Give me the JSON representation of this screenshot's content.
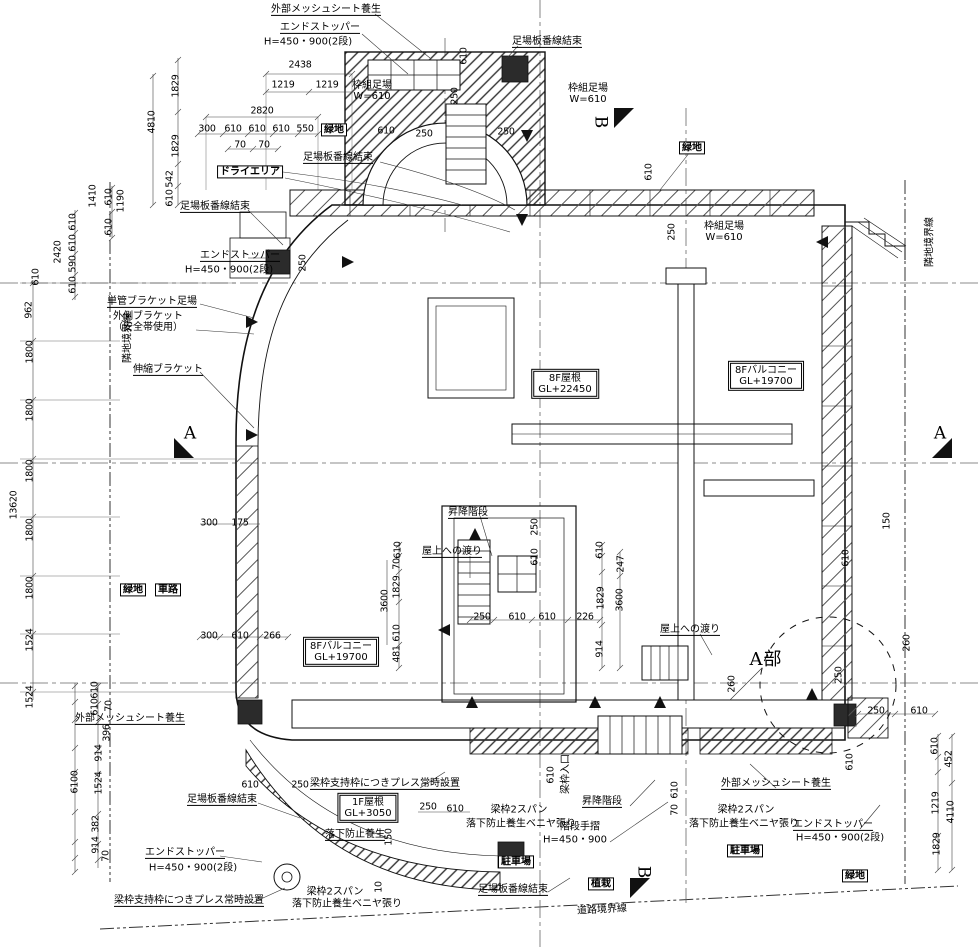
{
  "drawing": {
    "type": "scaffolding-plan",
    "canvas": {
      "width": 980,
      "height": 947
    },
    "colors": {
      "line": "#1a1a1a",
      "dim_line": "#444444",
      "background": "#ffffff"
    }
  },
  "labels": [
    {
      "name": "label-ext-mesh-sheet-top",
      "text": "外部メッシュシート養生",
      "x": 326,
      "y": 10,
      "cls": "u"
    },
    {
      "name": "label-end-stopper-top",
      "text": "エンドストッパー",
      "x": 320,
      "y": 28,
      "cls": "u"
    },
    {
      "name": "label-end-stopper-top-size",
      "text": "H=450・900(2段)",
      "x": 308,
      "y": 42
    },
    {
      "name": "label-scaffold-tie-top",
      "text": "足場板番線結束",
      "x": 547,
      "y": 42,
      "cls": "u"
    },
    {
      "name": "dim-label",
      "text": "2438",
      "x": 300,
      "y": 66,
      "cls": "dim"
    },
    {
      "name": "dim-label",
      "text": "1219",
      "x": 283,
      "y": 86,
      "cls": "dim"
    },
    {
      "name": "dim-label",
      "text": "1219",
      "x": 327,
      "y": 86,
      "cls": "dim"
    },
    {
      "name": "label-frame-scaffold-top-left",
      "text": "枠組足場\nW=610",
      "x": 372,
      "y": 91
    },
    {
      "name": "dim-label",
      "text": "610",
      "x": 465,
      "y": 56,
      "rot": -90,
      "cls": "dim"
    },
    {
      "name": "dim-label",
      "text": "250",
      "x": 456,
      "y": 96,
      "rot": -90,
      "cls": "dim"
    },
    {
      "name": "label-frame-scaffold-top-right",
      "text": "枠組足場\nW=610",
      "x": 588,
      "y": 94
    },
    {
      "name": "dim-label",
      "text": "2820",
      "x": 262,
      "y": 112,
      "cls": "dim"
    },
    {
      "name": "dim-label",
      "text": "300",
      "x": 207,
      "y": 130,
      "cls": "dim"
    },
    {
      "name": "dim-label",
      "text": "610",
      "x": 233,
      "y": 130,
      "cls": "dim"
    },
    {
      "name": "dim-label",
      "text": "610",
      "x": 257,
      "y": 130,
      "cls": "dim"
    },
    {
      "name": "dim-label",
      "text": "610",
      "x": 281,
      "y": 130,
      "cls": "dim"
    },
    {
      "name": "dim-label",
      "text": "550",
      "x": 305,
      "y": 130,
      "cls": "dim"
    },
    {
      "name": "dim-label",
      "text": "70",
      "x": 240,
      "y": 146,
      "cls": "dim"
    },
    {
      "name": "dim-label",
      "text": "70",
      "x": 264,
      "y": 146,
      "cls": "dim"
    },
    {
      "name": "label-greenery-top-left",
      "text": "緑地",
      "x": 334,
      "y": 130,
      "cls": "box"
    },
    {
      "name": "dim-label",
      "text": "610",
      "x": 386,
      "y": 132,
      "cls": "dim"
    },
    {
      "name": "dim-label",
      "text": "250",
      "x": 424,
      "y": 135,
      "cls": "dim"
    },
    {
      "name": "dim-label",
      "text": "250",
      "x": 506,
      "y": 133,
      "cls": "dim"
    },
    {
      "name": "label-greenery-top-right",
      "text": "緑地",
      "x": 692,
      "y": 148,
      "cls": "box"
    },
    {
      "name": "label-scaffold-tie-mid",
      "text": "足場板番線結束",
      "x": 338,
      "y": 158,
      "cls": "u"
    },
    {
      "name": "label-dry-area",
      "text": "ドライエリア",
      "x": 250,
      "y": 172,
      "cls": "box"
    },
    {
      "name": "label-scaffold-tie-left",
      "text": "足場板番線結束",
      "x": 215,
      "y": 207,
      "cls": "u"
    },
    {
      "name": "dim-label",
      "text": "1829",
      "x": 177,
      "y": 86,
      "rot": -90,
      "cls": "dim"
    },
    {
      "name": "dim-label",
      "text": "4810",
      "x": 153,
      "y": 122,
      "rot": -90,
      "cls": "dim"
    },
    {
      "name": "dim-label",
      "text": "1829",
      "x": 177,
      "y": 146,
      "rot": -90,
      "cls": "dim"
    },
    {
      "name": "dim-label",
      "text": "542",
      "x": 171,
      "y": 179,
      "rot": -90,
      "cls": "dim"
    },
    {
      "name": "dim-label",
      "text": "610",
      "x": 171,
      "y": 198,
      "rot": -90,
      "cls": "dim"
    },
    {
      "name": "dim-label",
      "text": "1410",
      "x": 94,
      "y": 196,
      "rot": -90,
      "cls": "dim"
    },
    {
      "name": "dim-label",
      "text": "610",
      "x": 110,
      "y": 197,
      "rot": -90,
      "cls": "dim"
    },
    {
      "name": "dim-label",
      "text": "1190",
      "x": 122,
      "y": 201,
      "rot": -90,
      "cls": "dim"
    },
    {
      "name": "dim-label",
      "text": "610",
      "x": 110,
      "y": 227,
      "rot": -90,
      "cls": "dim"
    },
    {
      "name": "dim-label",
      "text": "2420",
      "x": 59,
      "y": 252,
      "rot": -90,
      "cls": "dim"
    },
    {
      "name": "dim-label",
      "text": "610",
      "x": 74,
      "y": 222,
      "rot": -90,
      "cls": "dim"
    },
    {
      "name": "dim-label",
      "text": "610",
      "x": 74,
      "y": 243,
      "rot": -90,
      "cls": "dim"
    },
    {
      "name": "dim-label",
      "text": "590",
      "x": 74,
      "y": 264,
      "rot": -90,
      "cls": "dim"
    },
    {
      "name": "dim-label",
      "text": "610",
      "x": 74,
      "y": 285,
      "rot": -90,
      "cls": "dim"
    },
    {
      "name": "dim-label",
      "text": "610",
      "x": 37,
      "y": 277,
      "rot": -90,
      "cls": "dim"
    },
    {
      "name": "dim-label",
      "text": "962",
      "x": 30,
      "y": 310,
      "rot": -90,
      "cls": "dim"
    },
    {
      "name": "dim-label",
      "text": "610",
      "x": 650,
      "y": 172,
      "rot": -90,
      "cls": "dim"
    },
    {
      "name": "label-frame-scaffold-right",
      "text": "枠組足場\nW=610",
      "x": 724,
      "y": 232
    },
    {
      "name": "dim-label",
      "text": "250",
      "x": 673,
      "y": 232,
      "rot": -90,
      "cls": "dim"
    },
    {
      "name": "label-section-b-top",
      "text": "B",
      "x": 600,
      "y": 122,
      "rot": 90,
      "cls": "sec"
    },
    {
      "name": "label-boundary-right",
      "text": "隣地境界線",
      "x": 930,
      "y": 242,
      "rot": -90
    },
    {
      "name": "label-end-stopper-left",
      "text": "エンドストッパー",
      "x": 240,
      "y": 256,
      "cls": "u"
    },
    {
      "name": "label-end-stopper-left-size",
      "text": "H=450・900(2段)",
      "x": 229,
      "y": 270
    },
    {
      "name": "dim-label",
      "text": "250",
      "x": 304,
      "y": 263,
      "rot": -90,
      "cls": "dim"
    },
    {
      "name": "label-pipe-bracket",
      "text": "単管ブラケット足場",
      "x": 152,
      "y": 302,
      "cls": "u"
    },
    {
      "name": "label-outer-bracket",
      "text": "外側ブラケット\n（安全帯使用）",
      "x": 148,
      "y": 322
    },
    {
      "name": "label-boundary-left",
      "text": "隣地境界線",
      "x": 128,
      "y": 338,
      "rot": -90
    },
    {
      "name": "label-ext-bracket",
      "text": "伸縮ブラケット",
      "x": 168,
      "y": 370,
      "cls": "u"
    },
    {
      "name": "dim-label",
      "text": "1800",
      "x": 31,
      "y": 352,
      "rot": -90,
      "cls": "dim"
    },
    {
      "name": "dim-label",
      "text": "1800",
      "x": 31,
      "y": 410,
      "rot": -90,
      "cls": "dim"
    },
    {
      "name": "dim-label",
      "text": "1800",
      "x": 31,
      "y": 471,
      "rot": -90,
      "cls": "dim"
    },
    {
      "name": "dim-label",
      "text": "13620",
      "x": 15,
      "y": 505,
      "rot": -90,
      "cls": "dim"
    },
    {
      "name": "dim-label",
      "text": "1800",
      "x": 31,
      "y": 530,
      "rot": -90,
      "cls": "dim"
    },
    {
      "name": "dim-label",
      "text": "1800",
      "x": 31,
      "y": 588,
      "rot": -90,
      "cls": "dim"
    },
    {
      "name": "dim-label",
      "text": "1524",
      "x": 31,
      "y": 640,
      "rot": -90,
      "cls": "dim"
    },
    {
      "name": "dim-label",
      "text": "1524",
      "x": 31,
      "y": 697,
      "rot": -90,
      "cls": "dim"
    },
    {
      "name": "label-section-a-left",
      "text": "A",
      "x": 190,
      "y": 434,
      "cls": "sec"
    },
    {
      "name": "label-section-a-right",
      "text": "A",
      "x": 940,
      "y": 434,
      "cls": "sec"
    },
    {
      "name": "label-8f-roof",
      "text": "8F屋根\nGL+22450",
      "x": 565,
      "y": 384,
      "cls": "dbox"
    },
    {
      "name": "label-8f-balcony-right",
      "text": "8Fバルコニー\nGL+19700",
      "x": 766,
      "y": 376,
      "cls": "dbox"
    },
    {
      "name": "dim-label",
      "text": "300",
      "x": 209,
      "y": 524,
      "cls": "dim"
    },
    {
      "name": "dim-label",
      "text": "175",
      "x": 240,
      "y": 524,
      "cls": "dim"
    },
    {
      "name": "dim-label",
      "text": "150",
      "x": 888,
      "y": 521,
      "rot": -90,
      "cls": "dim"
    },
    {
      "name": "label-greenery-left",
      "text": "緑地",
      "x": 133,
      "y": 590,
      "cls": "box"
    },
    {
      "name": "label-roadway",
      "text": "車路",
      "x": 168,
      "y": 590,
      "cls": "box"
    },
    {
      "name": "label-lifting-stairs-top",
      "text": "昇降階段",
      "x": 468,
      "y": 513,
      "cls": "u"
    },
    {
      "name": "dim-label",
      "text": "250",
      "x": 536,
      "y": 527,
      "rot": -90,
      "cls": "dim"
    },
    {
      "name": "dim-label",
      "text": "610",
      "x": 536,
      "y": 557,
      "rot": -90,
      "cls": "dim"
    },
    {
      "name": "label-rooftop-pass-left",
      "text": "屋上への渡り",
      "x": 452,
      "y": 552,
      "cls": "u"
    },
    {
      "name": "dim-label",
      "text": "610",
      "x": 399,
      "y": 550,
      "rot": -90,
      "cls": "dim"
    },
    {
      "name": "dim-label",
      "text": "70",
      "x": 398,
      "y": 564,
      "rot": -90,
      "cls": "dim"
    },
    {
      "name": "dim-label",
      "text": "1829",
      "x": 398,
      "y": 587,
      "rot": -90,
      "cls": "dim"
    },
    {
      "name": "dim-label",
      "text": "3600",
      "x": 386,
      "y": 601,
      "rot": -90,
      "cls": "dim"
    },
    {
      "name": "dim-label",
      "text": "610",
      "x": 398,
      "y": 633,
      "rot": -90,
      "cls": "dim"
    },
    {
      "name": "dim-label",
      "text": "481",
      "x": 398,
      "y": 654,
      "rot": -90,
      "cls": "dim"
    },
    {
      "name": "dim-label",
      "text": "610",
      "x": 601,
      "y": 550,
      "rot": -90,
      "cls": "dim"
    },
    {
      "name": "dim-label",
      "text": "247",
      "x": 622,
      "y": 564,
      "rot": -90,
      "cls": "dim"
    },
    {
      "name": "dim-label",
      "text": "1829",
      "x": 602,
      "y": 598,
      "rot": -90,
      "cls": "dim"
    },
    {
      "name": "dim-label",
      "text": "3600",
      "x": 621,
      "y": 600,
      "rot": -90,
      "cls": "dim"
    },
    {
      "name": "dim-label",
      "text": "914",
      "x": 601,
      "y": 649,
      "rot": -90,
      "cls": "dim"
    },
    {
      "name": "dim-label",
      "text": "250",
      "x": 482,
      "y": 618,
      "cls": "dim"
    },
    {
      "name": "dim-label",
      "text": "610",
      "x": 517,
      "y": 618,
      "cls": "dim"
    },
    {
      "name": "dim-label",
      "text": "610",
      "x": 547,
      "y": 618,
      "cls": "dim"
    },
    {
      "name": "dim-label",
      "text": "226",
      "x": 585,
      "y": 618,
      "cls": "dim"
    },
    {
      "name": "label-8f-balcony-center",
      "text": "8Fバルコニー\nGL+19700",
      "x": 341,
      "y": 652,
      "cls": "dbox"
    },
    {
      "name": "dim-label",
      "text": "300",
      "x": 209,
      "y": 637,
      "cls": "dim"
    },
    {
      "name": "dim-label",
      "text": "610",
      "x": 240,
      "y": 637,
      "cls": "dim"
    },
    {
      "name": "dim-label",
      "text": "266",
      "x": 272,
      "y": 637,
      "cls": "dim"
    },
    {
      "name": "label-rooftop-pass-right",
      "text": "屋上への渡り",
      "x": 690,
      "y": 630,
      "cls": "u"
    },
    {
      "name": "label-a-part",
      "text": "A部",
      "x": 766,
      "y": 660,
      "cls": "big"
    },
    {
      "name": "dim-label",
      "text": "260",
      "x": 733,
      "y": 684,
      "rot": -90,
      "cls": "dim"
    },
    {
      "name": "dim-label",
      "text": "250",
      "x": 840,
      "y": 675,
      "rot": -90,
      "cls": "dim"
    },
    {
      "name": "dim-label",
      "text": "610",
      "x": 847,
      "y": 558,
      "rot": -90,
      "cls": "dim"
    },
    {
      "name": "dim-label",
      "text": "260",
      "x": 908,
      "y": 643,
      "rot": -90,
      "cls": "dim"
    },
    {
      "name": "dim-label",
      "text": "250",
      "x": 876,
      "y": 712,
      "cls": "dim"
    },
    {
      "name": "dim-label",
      "text": "610",
      "x": 919,
      "y": 712,
      "cls": "dim"
    },
    {
      "name": "label-ext-mesh-sheet-left",
      "text": "外部メッシュシート養生",
      "x": 130,
      "y": 719,
      "cls": "u"
    },
    {
      "name": "dim-label",
      "text": "610",
      "x": 96,
      "y": 690,
      "rot": -90,
      "cls": "dim"
    },
    {
      "name": "dim-label",
      "text": "610",
      "x": 96,
      "y": 707,
      "rot": -90,
      "cls": "dim"
    },
    {
      "name": "dim-label",
      "text": "70",
      "x": 110,
      "y": 706,
      "rot": -90,
      "cls": "dim"
    },
    {
      "name": "dim-label",
      "text": "396",
      "x": 108,
      "y": 733,
      "rot": -90,
      "cls": "dim"
    },
    {
      "name": "dim-label",
      "text": "914",
      "x": 100,
      "y": 753,
      "rot": -90,
      "cls": "dim"
    },
    {
      "name": "dim-label",
      "text": "6100",
      "x": 76,
      "y": 782,
      "rot": -90,
      "cls": "dim"
    },
    {
      "name": "dim-label",
      "text": "1524",
      "x": 100,
      "y": 783,
      "rot": -90,
      "cls": "dim"
    },
    {
      "name": "dim-label",
      "text": "382",
      "x": 97,
      "y": 824,
      "rot": -90,
      "cls": "dim"
    },
    {
      "name": "dim-label",
      "text": "914",
      "x": 97,
      "y": 845,
      "rot": -90,
      "cls": "dim"
    },
    {
      "name": "dim-label",
      "text": "70",
      "x": 107,
      "y": 856,
      "rot": -90,
      "cls": "dim"
    },
    {
      "name": "dim-label",
      "text": "610",
      "x": 250,
      "y": 786,
      "cls": "dim"
    },
    {
      "name": "dim-label",
      "text": "250",
      "x": 300,
      "y": 786,
      "cls": "dim"
    },
    {
      "name": "label-scaffold-tie-bl",
      "text": "足場板番線結束",
      "x": 222,
      "y": 800,
      "cls": "u"
    },
    {
      "name": "label-beam-press-top",
      "text": "梁枠支持枠につきプレス常時設置",
      "x": 385,
      "y": 784,
      "cls": "u"
    },
    {
      "name": "label-1f-roof",
      "text": "1F屋根\nGL+3050",
      "x": 368,
      "y": 808,
      "cls": "dbox"
    },
    {
      "name": "dim-label",
      "text": "250",
      "x": 428,
      "y": 808,
      "cls": "dim"
    },
    {
      "name": "dim-label",
      "text": "610",
      "x": 455,
      "y": 810,
      "cls": "dim"
    },
    {
      "name": "label-fall-prevention",
      "text": "落下防止養生",
      "x": 355,
      "y": 835,
      "cls": "u"
    },
    {
      "name": "dim-label",
      "text": "150",
      "x": 390,
      "y": 837,
      "rot": -90,
      "cls": "dim"
    },
    {
      "name": "dim-label",
      "text": "610",
      "x": 552,
      "y": 775,
      "rot": -90,
      "cls": "dim"
    },
    {
      "name": "label-beam-entrance",
      "text": "梁枠入口",
      "x": 566,
      "y": 774,
      "rot": -90
    },
    {
      "name": "label-beam-2span-center",
      "text": "梁枠2スパン",
      "x": 519,
      "y": 810
    },
    {
      "name": "label-fall-veneer-center",
      "text": "落下防止養生ベニヤ張り",
      "x": 521,
      "y": 824
    },
    {
      "name": "label-lifting-stairs-bottom",
      "text": "昇降階段",
      "x": 602,
      "y": 802,
      "cls": "u"
    },
    {
      "name": "dim-label",
      "text": "610",
      "x": 676,
      "y": 790,
      "rot": -90,
      "cls": "dim"
    },
    {
      "name": "dim-label",
      "text": "70",
      "x": 676,
      "y": 810,
      "rot": -90,
      "cls": "dim"
    },
    {
      "name": "label-stair-handrail",
      "text": "階段手摺",
      "x": 580,
      "y": 827
    },
    {
      "name": "label-stair-handrail-size",
      "text": "H=450・900",
      "x": 575,
      "y": 840
    },
    {
      "name": "label-beam-2span-right",
      "text": "梁枠2スパン",
      "x": 746,
      "y": 810
    },
    {
      "name": "label-fall-veneer-right",
      "text": "落下防止養生ベニヤ張り",
      "x": 744,
      "y": 824
    },
    {
      "name": "label-ext-mesh-sheet-bottom",
      "text": "外部メッシュシート養生",
      "x": 776,
      "y": 784,
      "cls": "u"
    },
    {
      "name": "label-end-stopper-br",
      "text": "エンドストッパー",
      "x": 833,
      "y": 825,
      "cls": "u"
    },
    {
      "name": "label-end-stopper-br-size",
      "text": "H=450・900(2段)",
      "x": 840,
      "y": 838
    },
    {
      "name": "label-parking-left",
      "text": "駐車場",
      "x": 516,
      "y": 862,
      "cls": "box"
    },
    {
      "name": "label-parking-right",
      "text": "駐車場",
      "x": 745,
      "y": 851,
      "cls": "box"
    },
    {
      "name": "label-planting",
      "text": "植栽",
      "x": 601,
      "y": 884,
      "cls": "box"
    },
    {
      "name": "label-section-b-bottom",
      "text": "B",
      "x": 643,
      "y": 872,
      "rot": 90,
      "cls": "sec"
    },
    {
      "name": "label-greenery-br",
      "text": "緑地",
      "x": 855,
      "y": 876,
      "cls": "box"
    },
    {
      "name": "label-scaffold-tie-bc",
      "text": "足場板番線結束",
      "x": 513,
      "y": 890,
      "cls": "u"
    },
    {
      "name": "label-end-stopper-bl",
      "text": "エンドストッパー",
      "x": 185,
      "y": 853,
      "cls": "u"
    },
    {
      "name": "label-end-stopper-bl-size",
      "text": "H=450・900(2段)",
      "x": 193,
      "y": 868
    },
    {
      "name": "label-beam-press-bottom",
      "text": "梁枠支持枠につきプレス常時設置",
      "x": 189,
      "y": 901,
      "cls": "u"
    },
    {
      "name": "label-beam-2span-bottom",
      "text": "梁枠2スパン",
      "x": 335,
      "y": 892
    },
    {
      "name": "label-fall-veneer-bottom",
      "text": "落下防止養生ベニヤ張り",
      "x": 347,
      "y": 904
    },
    {
      "name": "dim-label",
      "text": "10",
      "x": 380,
      "y": 887,
      "rot": -90,
      "cls": "dim"
    },
    {
      "name": "label-road-boundary",
      "text": "道路境界線",
      "x": 602,
      "y": 910,
      "rot": -3
    },
    {
      "name": "dim-label",
      "text": "610",
      "x": 851,
      "y": 762,
      "rot": -90,
      "cls": "dim"
    },
    {
      "name": "dim-label",
      "text": "610",
      "x": 936,
      "y": 746,
      "rot": -90,
      "cls": "dim"
    },
    {
      "name": "dim-label",
      "text": "452",
      "x": 950,
      "y": 759,
      "rot": -90,
      "cls": "dim"
    },
    {
      "name": "dim-label",
      "text": "1219",
      "x": 937,
      "y": 803,
      "rot": -90,
      "cls": "dim"
    },
    {
      "name": "dim-label",
      "text": "4110",
      "x": 952,
      "y": 812,
      "rot": -90,
      "cls": "dim"
    },
    {
      "name": "dim-label",
      "text": "1829",
      "x": 938,
      "y": 844,
      "rot": -90,
      "cls": "dim"
    }
  ]
}
